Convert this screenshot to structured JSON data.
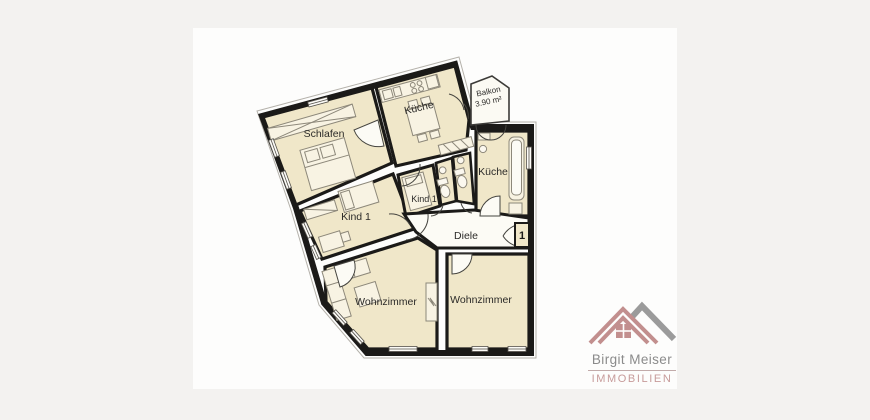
{
  "page": {
    "background": "#f3f2f0",
    "card_background": "#fdfdfc"
  },
  "floorplan": {
    "labels": {
      "schlafen": "Schlafen",
      "kueche_top": "Küche",
      "kueche_right": "Küche",
      "kind1_left": "Kind 1",
      "kind1_small": "Kind 1",
      "diele": "Diele",
      "wohnzimmer_left": "Wohnzimmer",
      "wohnzimmer_right": "Wohnzimmer",
      "balkon_name": "Balkon",
      "balkon_area": "3.90 m²",
      "entrance": "1"
    },
    "colors": {
      "room_fill": "#f0e7c9",
      "hall_fill": "#fcfbf5",
      "wall": "#1b1a18",
      "furniture_stroke": "#8d887a"
    }
  },
  "logo": {
    "name": "Birgit Meiser",
    "tagline": "IMMOBILIEN",
    "rose": "#c28f8e",
    "gray": "#9b9b9b"
  }
}
